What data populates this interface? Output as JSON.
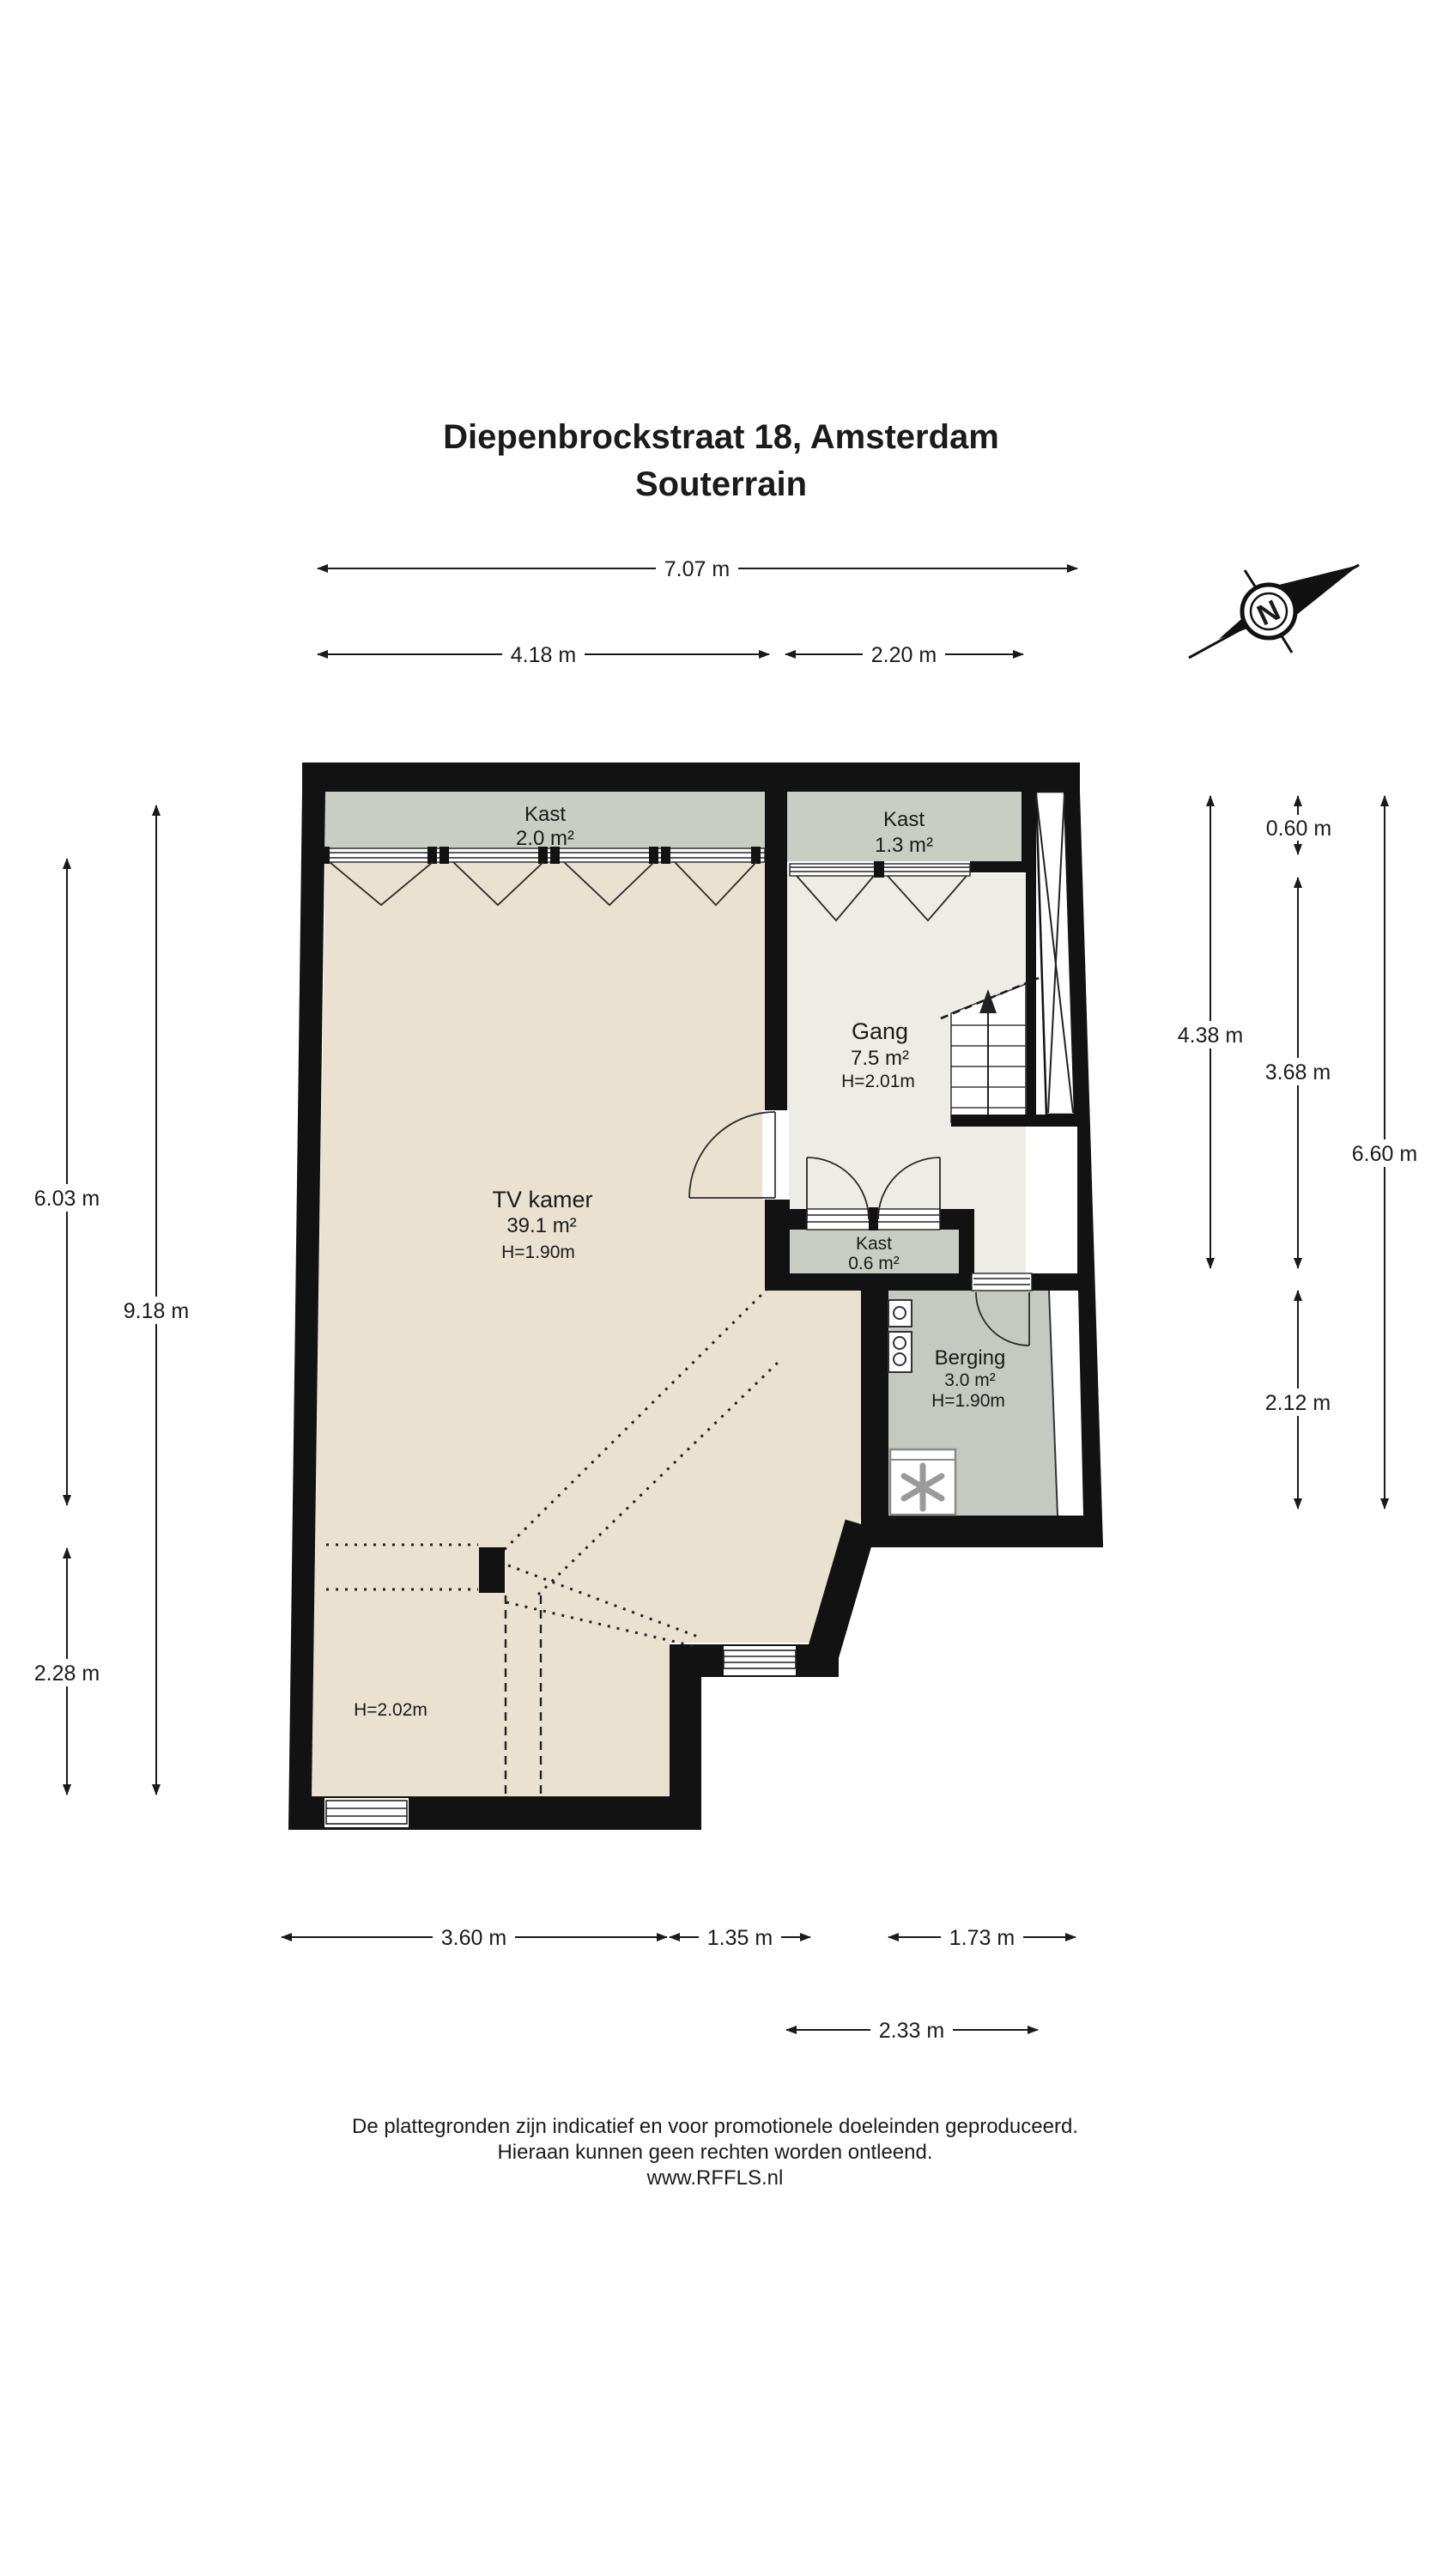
{
  "page": {
    "title_line1": "Diepenbrockstraat 18, Amsterdam",
    "title_line2": "Souterrain"
  },
  "compass": {
    "label": "N"
  },
  "rooms": {
    "kast_top": {
      "name": "Kast",
      "area": "2.0 m²"
    },
    "kast_right": {
      "name": "Kast",
      "area": "1.3 m²"
    },
    "gang": {
      "name": "Gang",
      "area": "7.5 m²",
      "height": "H=2.01m"
    },
    "tv_kamer": {
      "name": "TV kamer",
      "area": "39.1 m²",
      "height": "H=1.90m"
    },
    "kast_small": {
      "name": "Kast",
      "area": "0.6 m²"
    },
    "berging": {
      "name": "Berging",
      "area": "3.0 m²",
      "height": "H=1.90m"
    },
    "low_ceiling_area": {
      "height": "H=2.02m"
    }
  },
  "dimensions": {
    "top": [
      {
        "label": "7.07 m"
      },
      {
        "label": "4.18 m"
      },
      {
        "label": "2.20 m"
      }
    ],
    "left": [
      {
        "label": "6.03 m"
      },
      {
        "label": "9.18 m"
      },
      {
        "label": "2.28 m"
      }
    ],
    "right": [
      {
        "label": "0.60 m"
      },
      {
        "label": "4.38 m"
      },
      {
        "label": "3.68 m"
      },
      {
        "label": "6.60 m"
      },
      {
        "label": "2.12 m"
      }
    ],
    "bottom": [
      {
        "label": "3.60 m"
      },
      {
        "label": "1.35 m"
      },
      {
        "label": "1.73 m"
      },
      {
        "label": "2.33 m"
      }
    ]
  },
  "footer": {
    "line1": "De plattegronden zijn indicatief en voor promotionele doeleinden geproduceerd.",
    "line2": "Hieraan kunnen geen rechten worden ontleend.",
    "line3": "www.RFFLS.nl"
  },
  "colors": {
    "wall": "#121212",
    "floor_main": "#EAE1D1",
    "floor_hall": "#EDECE6",
    "closet": "#C9CDC4",
    "storage": "#C5C9C1",
    "dimension_line": "#1a1a1a"
  }
}
